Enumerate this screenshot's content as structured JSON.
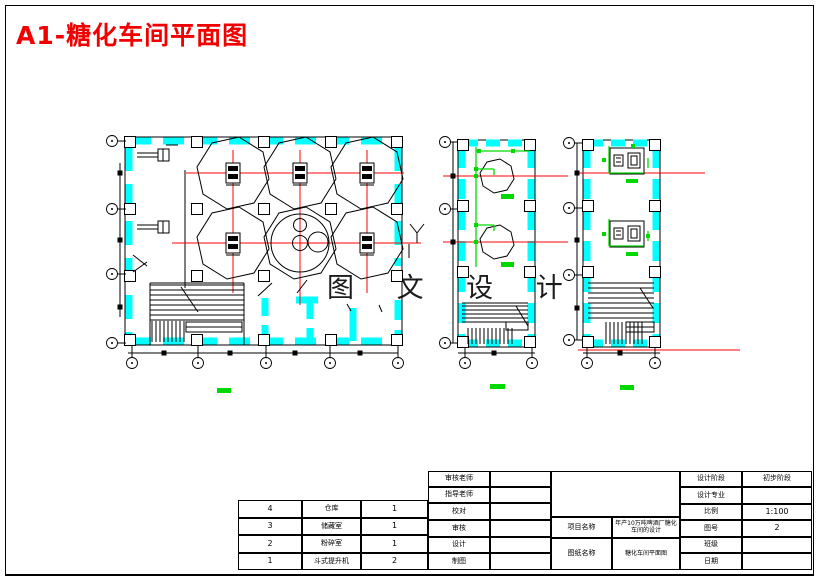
{
  "sheet": {
    "title": "A1-糖化车间平面图",
    "watermark": "图 文 设 计"
  },
  "colors": {
    "title_red": "#f20000",
    "wall_highlight": "#00ffff",
    "centerline_red": "#ff0000",
    "piping_green": "#00d900"
  },
  "room_table": {
    "rows": [
      {
        "no": "4",
        "name": "仓库",
        "qty": "1"
      },
      {
        "no": "3",
        "name": "储藏室",
        "qty": "1"
      },
      {
        "no": "2",
        "name": "粉碎室",
        "qty": "1"
      },
      {
        "no": "1",
        "name": "斗式提升机",
        "qty": "2"
      }
    ]
  },
  "title_block": {
    "review_teacher_label": "审核老师",
    "review_teacher_value": "",
    "advisor_label": "指导老师",
    "advisor_value": "",
    "proofread_label": "校对",
    "proofread_value": "",
    "review_label": "审核",
    "review_value": "",
    "design_label": "设计",
    "design_value": "",
    "draft_label": "制图",
    "draft_value": "",
    "project_label": "项目名称",
    "project_name": "年产10万吨啤酒厂糖化车间的设计",
    "drawing_label": "图纸名称",
    "drawing_name": "糖化车间平面图",
    "phase_label": "设计阶段",
    "phase_value": "初步阶段",
    "major_label": "设计专业",
    "major_value": "",
    "scale_label": "比例",
    "scale_value": "1:100",
    "figure_no_label": "图号",
    "figure_no_value": "2",
    "class_label": "班级",
    "class_value": "",
    "date_label": "日期",
    "date_value": ""
  }
}
